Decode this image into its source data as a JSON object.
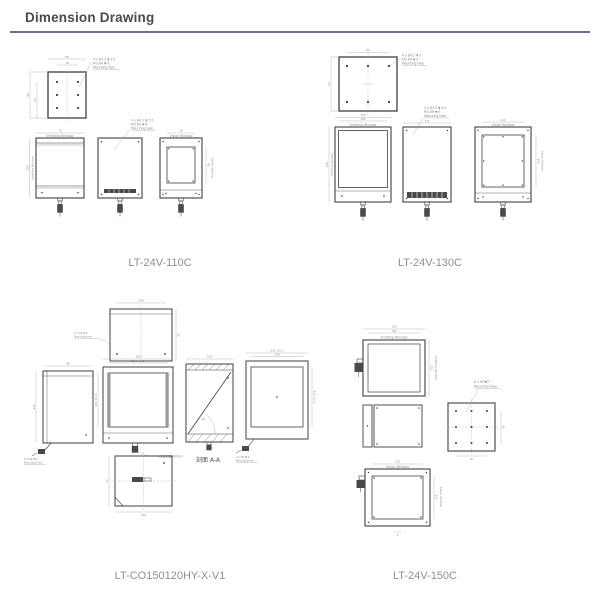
{
  "page": {
    "title": "Dimension Drawing"
  },
  "colors": {
    "accent": "#7a62a8",
    "heading_text": "#4a4a4a",
    "product_label_text": "#8f8f8f",
    "drawing_line": "#3f3f3f",
    "dim_text": "#8a8a8a"
  },
  "products": [
    {
      "name": "LT-24V-110C"
    },
    {
      "name": "LT-24V-130C"
    },
    {
      "name": "LT-CO150120HY-X-V1"
    },
    {
      "name": "LT-24V-150C"
    }
  ],
  "d1": {
    "emitting_window": "Emitting Window",
    "vision_window": "Vision Window",
    "top_callout": [
      "4 x Ø3.2 ▼ 3.5",
      "M3-6H ▼ 6",
      "Mounting hole"
    ],
    "side_callout": [
      "4 x Ø4.2 ▼ 5.5",
      "M3-6H ▼ 6",
      "Mounting hole"
    ],
    "dims": {
      "tv_w1": "42",
      "tv_w2": "58",
      "tv_h1": "96",
      "tv_h2": "64",
      "fv_w": "70",
      "fv_h": "110",
      "bv_w": "56",
      "bv_win": "45"
    }
  },
  "d2": {
    "emitting_window": "Emitting Window",
    "vision_window": "Vision Window",
    "top_callout": [
      "4 x Ø4.2 ▼ 5",
      "M3-6H ▼ 6",
      "Mounting hole"
    ],
    "side_callout": [
      "2 x Ø3.3 ▼ 6.5",
      "M3-6H ▼ 6",
      "Mounting hole"
    ],
    "dims": {
      "tv_w": "60",
      "tv_h": "52",
      "fv_w1": "130",
      "fv_w2": "104",
      "fv_h": "130",
      "sv_w": "111",
      "bv_w": "110",
      "bv_h": "100"
    }
  },
  "d3": {
    "section_label": "剖面 A-A",
    "cable_note": "线缆长度600mm",
    "angle": "45°",
    "top_callout": [
      "2 x M4 ▼ 6",
      "Mounting hole"
    ],
    "left_callout": [
      "4 x M4 ▼ 6",
      "Mounting hole"
    ],
    "right_callout": [
      "4 x M4 ▼ 6",
      "Mounting hole"
    ],
    "dims": {
      "tv_w": "148",
      "tv_h": "96",
      "lv_w": "96",
      "lv_h": "120",
      "fv_w1": "136 ±0.5",
      "fv_w2": "160",
      "fv_h": "105 ±0.5",
      "sv_w": "107",
      "rv_w1": "150 ±0.5",
      "rv_w2": "140",
      "rv_h": "120 ±0.5",
      "bv_w": "148",
      "bv_h": "52"
    }
  },
  "d4": {
    "emitting_window": "Emitting Window",
    "vision_window": "Vision Window",
    "mount_callout": [
      "6 x M3▼7",
      "Mounting Hole"
    ],
    "dims": {
      "fv_w1": "150",
      "fv_w2": "142",
      "fv_h": "150",
      "bv_p": "45",
      "bv_w": "90",
      "vv_w": "120",
      "vv_h": "120",
      "vv_b": "9"
    }
  }
}
